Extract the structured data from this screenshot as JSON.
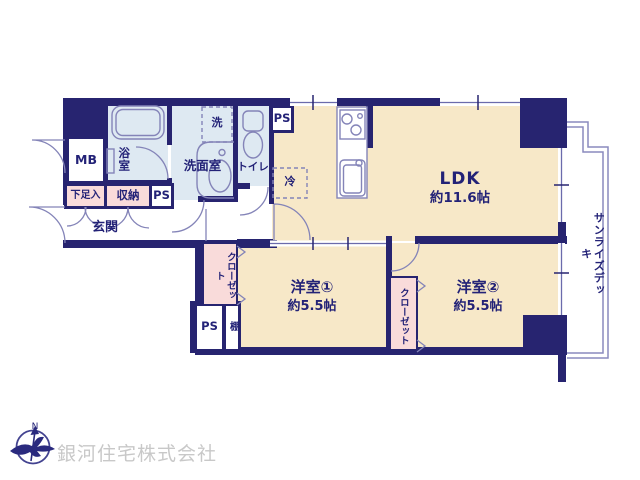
{
  "plan": {
    "rooms": {
      "ldk": {
        "name": "LDK",
        "size": "約11.6帖"
      },
      "bedroom1": {
        "name": "洋室①",
        "size": "約5.5帖"
      },
      "bedroom2": {
        "name": "洋室②",
        "size": "約5.5帖"
      },
      "bathroom": "浴室",
      "washroom": "洗面室",
      "toilet": "トイレ",
      "entrance": "玄関",
      "deck": "サンライズデッキ"
    },
    "storage": {
      "shoe_box": "下足入",
      "hall_closet": "収納",
      "closet1": "クローゼット",
      "closet2": "クローゼット",
      "shelf": "棚"
    },
    "labels": {
      "meter_box": "MB",
      "ps_hall": "PS",
      "ps_top": "PS",
      "ps_bottom": "PS",
      "washer": "洗",
      "fridge": "冷"
    },
    "colors": {
      "wall": "#272470",
      "floor": "#f7e8c8",
      "wet_area": "#dee9f2",
      "storage": "#f9dbda",
      "line": "#8484b8",
      "text": "#232277",
      "company": "#c8c8c8"
    }
  },
  "footer": {
    "company": "銀河住宅株式会社",
    "compass_north": "N"
  }
}
